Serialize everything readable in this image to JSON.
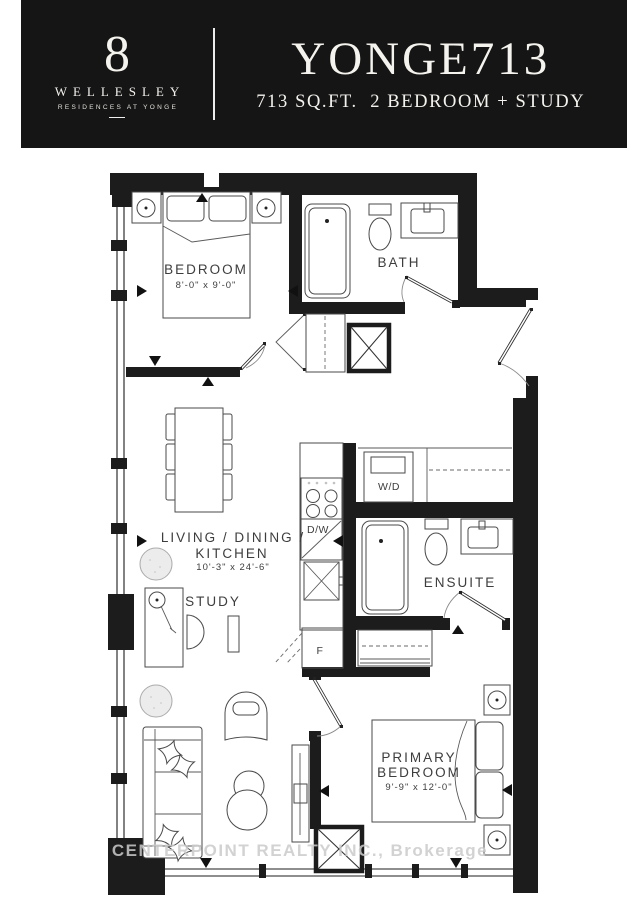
{
  "header": {
    "logo_number": "8",
    "logo_name": "WELLESLEY",
    "logo_tagline": "RESIDENCES AT YONGE",
    "title": "YONGE713",
    "subtitle": "713 SQ.FT.  2 BEDROOM + STUDY"
  },
  "plan": {
    "rooms": {
      "bedroom": {
        "name": "BEDROOM",
        "dims": "8'-0\" x 9'-0\""
      },
      "bath": {
        "name": "BATH"
      },
      "living": {
        "line1": "LIVING / DINING /",
        "line2": "KITCHEN",
        "dims": "10'-3\" x 24'-6\""
      },
      "study": {
        "name": "STUDY"
      },
      "ensuite": {
        "name": "ENSUITE"
      },
      "primary_bedroom": {
        "line1": "PRIMARY",
        "line2": "BEDROOM",
        "dims": "9'-9\" x 12'-0\""
      }
    },
    "appliances": {
      "washer_dryer": "W/D",
      "dishwasher": "D/W",
      "fridge": "F"
    }
  },
  "watermark": "CENTERPOINT REALTY INC., Brokerage",
  "colors": {
    "header_bg": "#151515",
    "header_text": "#f5f3ee",
    "wall": "#1c1c1c",
    "furniture_line": "#4a4a4a",
    "label_text": "#3d3d3d",
    "watermark": "#cbcbcb"
  }
}
